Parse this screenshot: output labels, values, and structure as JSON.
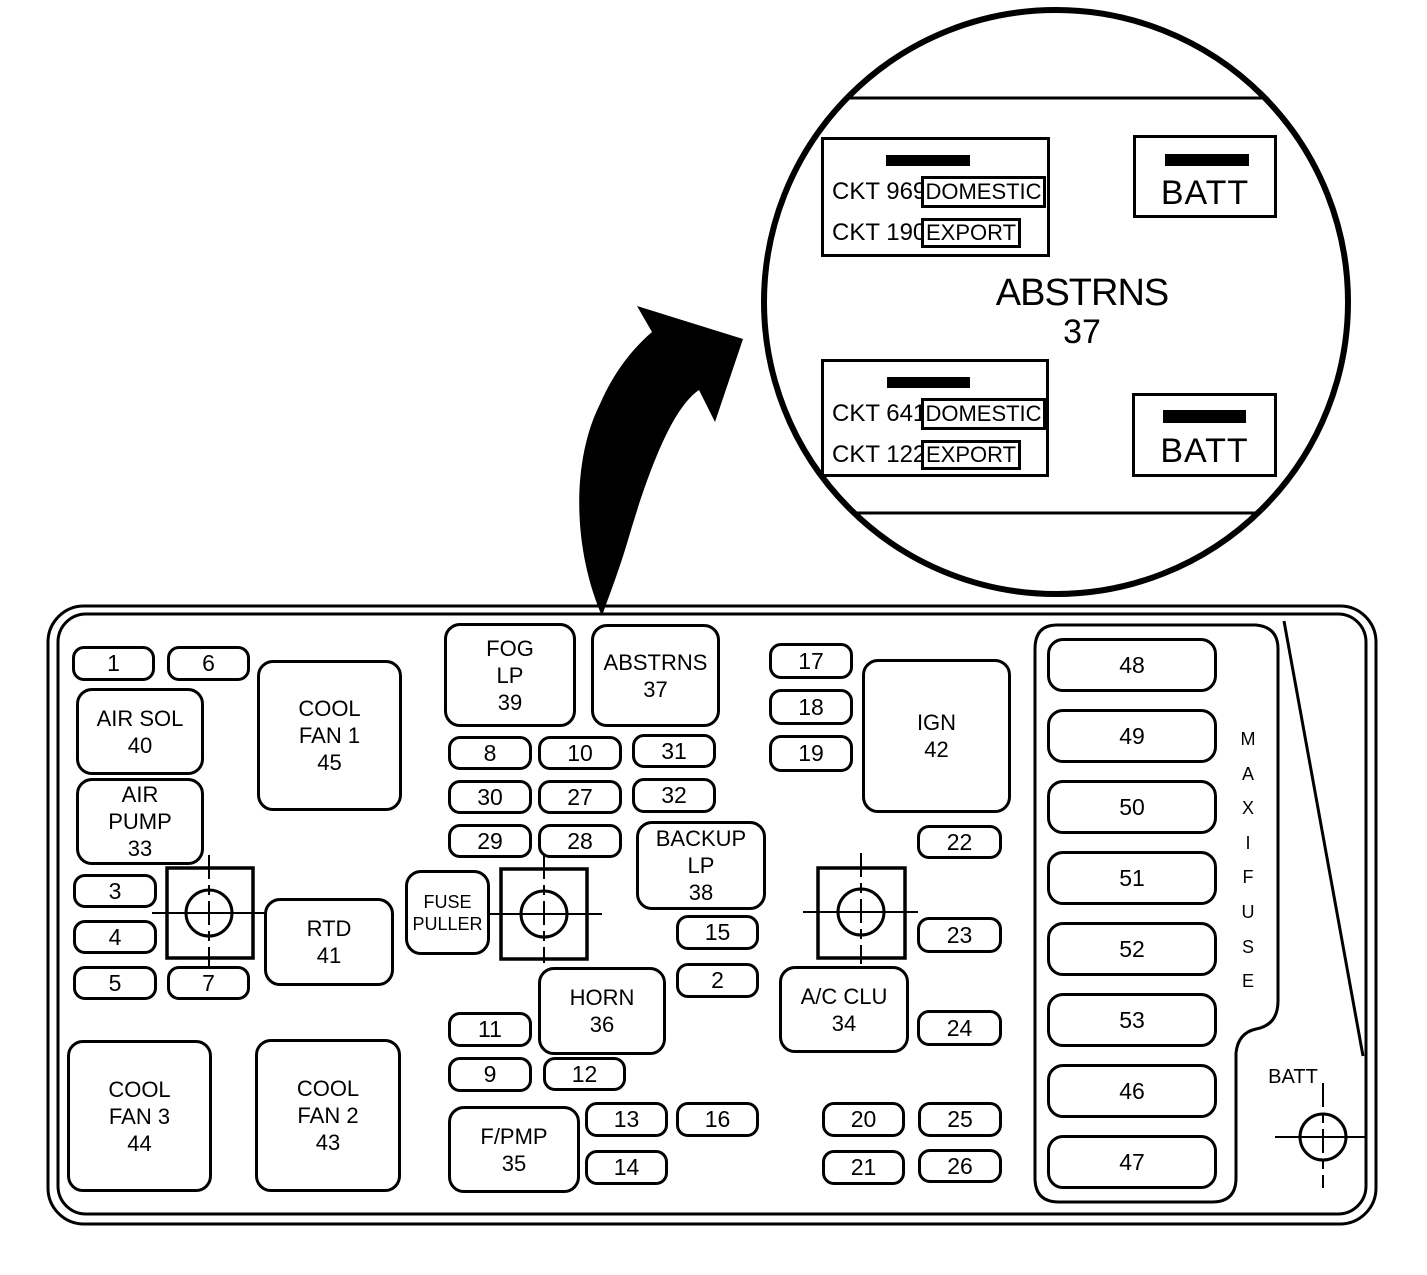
{
  "colors": {
    "ink": "#000000",
    "paper": "#ffffff"
  },
  "magnifier": {
    "title": "ABSTRNS",
    "number": "37",
    "connectors": [
      {
        "rows": [
          {
            "ckt": "CKT 969",
            "tag": "DOMESTIC"
          },
          {
            "ckt": "CKT 1901",
            "tag": "EXPORT"
          }
        ]
      },
      {
        "rows": [
          {
            "ckt": "CKT 641",
            "tag": "DOMESTIC"
          },
          {
            "ckt": "CKT 122",
            "tag": "EXPORT"
          }
        ]
      }
    ],
    "terminals": [
      {
        "label": "BATT"
      },
      {
        "label": "BATT"
      }
    ]
  },
  "panel": {
    "maxifuse_label": "MAXIFUSE",
    "batt_label": "BATT",
    "small_fuses": [
      {
        "label": "1",
        "x": 72,
        "y": 646,
        "w": 83,
        "h": 35
      },
      {
        "label": "6",
        "x": 167,
        "y": 646,
        "w": 83,
        "h": 35
      },
      {
        "label": "8",
        "x": 448,
        "y": 736,
        "w": 84,
        "h": 34
      },
      {
        "label": "10",
        "x": 538,
        "y": 736,
        "w": 84,
        "h": 34
      },
      {
        "label": "31",
        "x": 632,
        "y": 734,
        "w": 84,
        "h": 34
      },
      {
        "label": "30",
        "x": 448,
        "y": 780,
        "w": 84,
        "h": 34
      },
      {
        "label": "27",
        "x": 538,
        "y": 780,
        "w": 84,
        "h": 34
      },
      {
        "label": "32",
        "x": 632,
        "y": 778,
        "w": 84,
        "h": 35
      },
      {
        "label": "29",
        "x": 448,
        "y": 824,
        "w": 84,
        "h": 34
      },
      {
        "label": "28",
        "x": 538,
        "y": 824,
        "w": 84,
        "h": 34
      },
      {
        "label": "17",
        "x": 769,
        "y": 643,
        "w": 84,
        "h": 36
      },
      {
        "label": "18",
        "x": 769,
        "y": 689,
        "w": 84,
        "h": 36
      },
      {
        "label": "19",
        "x": 769,
        "y": 735,
        "w": 84,
        "h": 37
      },
      {
        "label": "3",
        "x": 73,
        "y": 874,
        "w": 84,
        "h": 34
      },
      {
        "label": "4",
        "x": 73,
        "y": 920,
        "w": 84,
        "h": 34
      },
      {
        "label": "5",
        "x": 73,
        "y": 966,
        "w": 84,
        "h": 34
      },
      {
        "label": "7",
        "x": 167,
        "y": 966,
        "w": 83,
        "h": 34
      },
      {
        "label": "22",
        "x": 917,
        "y": 825,
        "w": 85,
        "h": 34
      },
      {
        "label": "23",
        "x": 917,
        "y": 917,
        "w": 85,
        "h": 36
      },
      {
        "label": "24",
        "x": 917,
        "y": 1010,
        "w": 85,
        "h": 36
      },
      {
        "label": "15",
        "x": 676,
        "y": 915,
        "w": 83,
        "h": 35
      },
      {
        "label": "2",
        "x": 676,
        "y": 963,
        "w": 83,
        "h": 35
      },
      {
        "label": "11",
        "x": 448,
        "y": 1012,
        "w": 84,
        "h": 35
      },
      {
        "label": "9",
        "x": 448,
        "y": 1057,
        "w": 84,
        "h": 35
      },
      {
        "label": "12",
        "x": 543,
        "y": 1057,
        "w": 83,
        "h": 34
      },
      {
        "label": "13",
        "x": 585,
        "y": 1102,
        "w": 83,
        "h": 35
      },
      {
        "label": "16",
        "x": 676,
        "y": 1102,
        "w": 83,
        "h": 35
      },
      {
        "label": "14",
        "x": 585,
        "y": 1150,
        "w": 83,
        "h": 35
      },
      {
        "label": "20",
        "x": 822,
        "y": 1102,
        "w": 83,
        "h": 35
      },
      {
        "label": "21",
        "x": 822,
        "y": 1150,
        "w": 83,
        "h": 35
      },
      {
        "label": "25",
        "x": 918,
        "y": 1102,
        "w": 84,
        "h": 35
      },
      {
        "label": "26",
        "x": 918,
        "y": 1149,
        "w": 84,
        "h": 34
      }
    ],
    "large_fuses": [
      {
        "lines": [
          "AIR SOL",
          "40"
        ],
        "x": 76,
        "y": 688,
        "w": 128,
        "h": 87
      },
      {
        "lines": [
          "AIR",
          "PUMP",
          "33"
        ],
        "x": 76,
        "y": 778,
        "w": 128,
        "h": 87
      },
      {
        "lines": [
          "COOL",
          "FAN 1",
          "45"
        ],
        "x": 257,
        "y": 660,
        "w": 145,
        "h": 151
      },
      {
        "lines": [
          "FOG",
          "LP",
          "39"
        ],
        "x": 444,
        "y": 623,
        "w": 132,
        "h": 104
      },
      {
        "lines": [
          "ABSTRNS",
          "37"
        ],
        "x": 591,
        "y": 624,
        "w": 129,
        "h": 103
      },
      {
        "lines": [
          "IGN",
          "42"
        ],
        "x": 862,
        "y": 659,
        "w": 149,
        "h": 154
      },
      {
        "lines": [
          "RTD",
          "41"
        ],
        "x": 264,
        "y": 898,
        "w": 130,
        "h": 88
      },
      {
        "lines": [
          "FUSE",
          "PULLER"
        ],
        "x": 405,
        "y": 870,
        "w": 85,
        "h": 85,
        "tiny": true
      },
      {
        "lines": [
          "BACKUP",
          "LP",
          "38"
        ],
        "x": 636,
        "y": 821,
        "w": 130,
        "h": 89
      },
      {
        "lines": [
          "HORN",
          "36"
        ],
        "x": 538,
        "y": 967,
        "w": 128,
        "h": 88
      },
      {
        "lines": [
          "A/C CLU",
          "34"
        ],
        "x": 779,
        "y": 966,
        "w": 130,
        "h": 87
      },
      {
        "lines": [
          "COOL",
          "FAN 3",
          "44"
        ],
        "x": 67,
        "y": 1040,
        "w": 145,
        "h": 152
      },
      {
        "lines": [
          "COOL",
          "FAN 2",
          "43"
        ],
        "x": 255,
        "y": 1039,
        "w": 146,
        "h": 153
      },
      {
        "lines": [
          "F/PMP",
          "35"
        ],
        "x": 448,
        "y": 1106,
        "w": 132,
        "h": 87
      }
    ],
    "maxi_fuses": [
      {
        "label": "48",
        "x": 1047,
        "y": 638,
        "w": 170,
        "h": 54
      },
      {
        "label": "49",
        "x": 1047,
        "y": 709,
        "w": 170,
        "h": 54
      },
      {
        "label": "50",
        "x": 1047,
        "y": 780,
        "w": 170,
        "h": 54
      },
      {
        "label": "51",
        "x": 1047,
        "y": 851,
        "w": 170,
        "h": 54
      },
      {
        "label": "52",
        "x": 1047,
        "y": 922,
        "w": 170,
        "h": 54
      },
      {
        "label": "53",
        "x": 1047,
        "y": 993,
        "w": 170,
        "h": 54
      },
      {
        "label": "46",
        "x": 1047,
        "y": 1064,
        "w": 170,
        "h": 54
      },
      {
        "label": "47",
        "x": 1047,
        "y": 1135,
        "w": 170,
        "h": 54
      }
    ]
  }
}
